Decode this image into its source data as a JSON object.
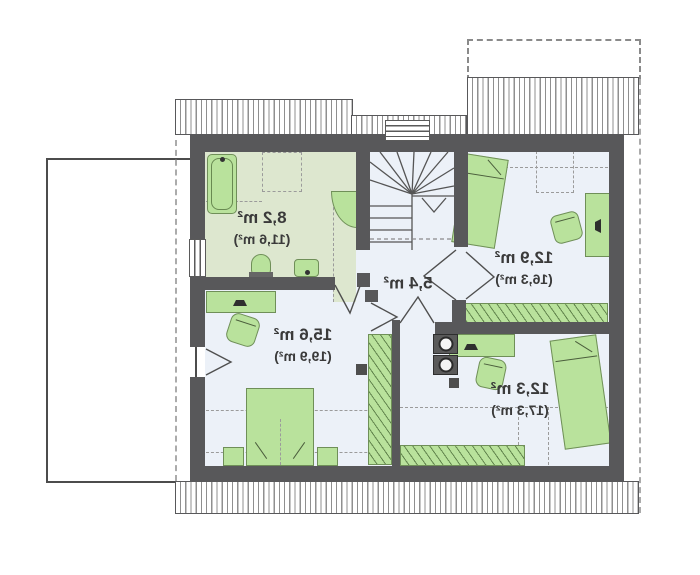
{
  "plan": {
    "kind": "attic-floor-plan",
    "text_mirrored": true,
    "units": "m²"
  },
  "rooms": [
    {
      "id": "bathroom",
      "area": "8,2 m²",
      "area_total": "(11,6 m²)"
    },
    {
      "id": "room-top-right",
      "area": "12,9 m²",
      "area_total": "(16,3 m²)"
    },
    {
      "id": "hall",
      "area": "5,4 m²",
      "area_total": ""
    },
    {
      "id": "room-bottom-left",
      "area": "15,6 m²",
      "area_total": "(19,9 m²)"
    },
    {
      "id": "room-bottom-right",
      "area": "12,3 m²",
      "area_total": "(17,3 m²)"
    }
  ],
  "colors": {
    "wall": "#58585a",
    "floor": "#ecf1f8",
    "bathfloor": "#dde7cf",
    "furn": "#b9e29c",
    "furnline": "#6f8f58",
    "dash": "#9b9b9b",
    "roofline": "#8f8f8f",
    "balconyline": "#4c4c4c",
    "text": "#3a3a3a"
  }
}
